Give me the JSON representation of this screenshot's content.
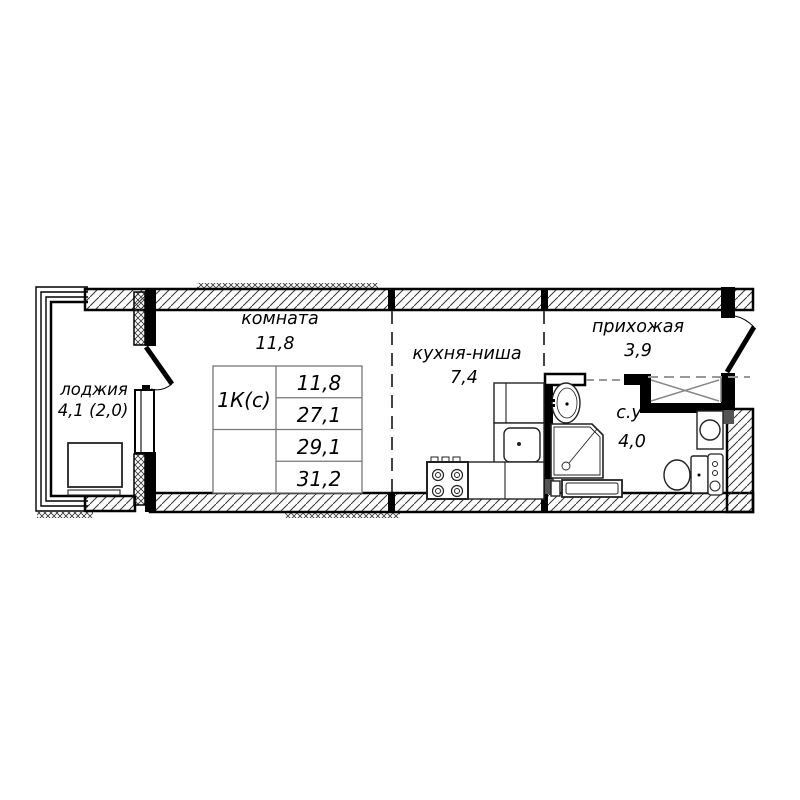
{
  "rooms": {
    "room": {
      "label": "комната",
      "area": "11,8"
    },
    "kitchen": {
      "label": "кухня-ниша",
      "area": "7,4"
    },
    "hallway": {
      "label": "прихожая",
      "area": "3,9"
    },
    "bathroom": {
      "label": "с.у",
      "area": "4,0"
    },
    "loggia": {
      "label": "лоджия",
      "area": "4,1 (2,0)"
    }
  },
  "spec_table": {
    "type_label": "1К(с)",
    "values": [
      "11,8",
      "27,1",
      "29,1",
      "31,2"
    ]
  },
  "colors": {
    "background": "#ffffff",
    "wall": "#000000",
    "partition_dash": "#444444",
    "light_dash": "#999999",
    "fixture": "#222222",
    "table_border": "#777777"
  }
}
